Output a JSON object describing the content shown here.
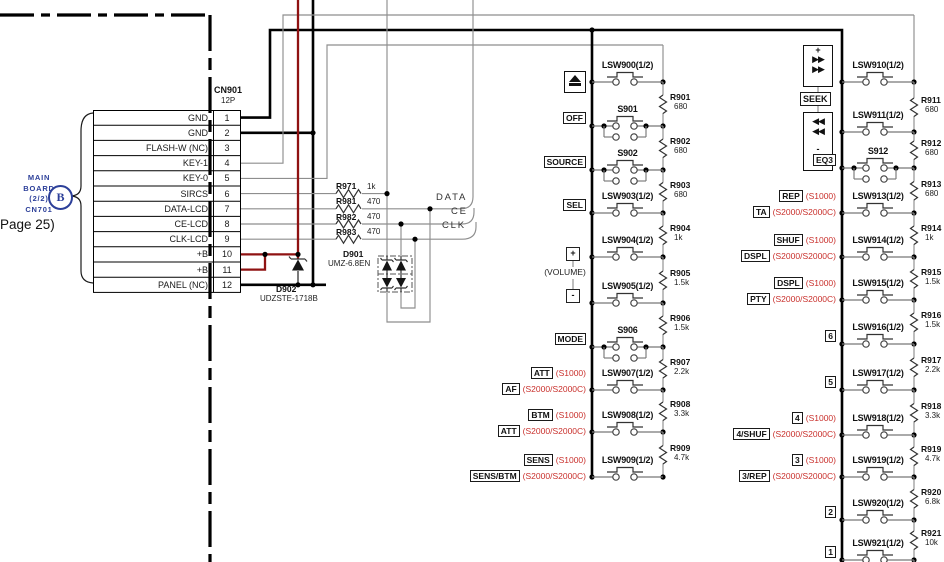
{
  "connector": {
    "name": "CN901",
    "type_label": "12P",
    "pins": [
      {
        "no": "1",
        "name": "GND"
      },
      {
        "no": "2",
        "name": "GND"
      },
      {
        "no": "3",
        "name": "FLASH-W (NC)"
      },
      {
        "no": "4",
        "name": "KEY-1"
      },
      {
        "no": "5",
        "name": "KEY-0"
      },
      {
        "no": "6",
        "name": "SIRCS"
      },
      {
        "no": "7",
        "name": "DATA-LCD"
      },
      {
        "no": "8",
        "name": "CE-LCD"
      },
      {
        "no": "9",
        "name": "CLK-LCD"
      },
      {
        "no": "10",
        "name": "+B"
      },
      {
        "no": "11",
        "name": "+B"
      },
      {
        "no": "12",
        "name": "PANEL (NC)"
      }
    ]
  },
  "left_note": {
    "lines": [
      "MAIN",
      "BOARD",
      "(2/2)",
      "CN701"
    ],
    "circle_letter": "B",
    "page_ref": "Page 25)"
  },
  "inline_resistors": [
    {
      "name": "R971",
      "value": "1k"
    },
    {
      "name": "R981",
      "value": "470"
    },
    {
      "name": "R982",
      "value": "470"
    },
    {
      "name": "R983",
      "value": "470"
    }
  ],
  "signals": {
    "data": "DATA",
    "ce": "CE",
    "clk": "CLK"
  },
  "diodes": {
    "d901": {
      "name": "D901",
      "part": "UMZ-6.8EN"
    },
    "d902": {
      "name": "D902",
      "part": "UDZSTE-1718B"
    }
  },
  "volume_group": {
    "plus": "+",
    "label": "(VOLUME)",
    "minus": "-"
  },
  "seek_group": {
    "plus": "+",
    "forward": "▶▶",
    "rewind": "◀◀",
    "label": "SEEK",
    "minus": "-"
  },
  "middle_column": {
    "rows": [
      {
        "switch": "LSW900(1/2)",
        "type": "lsw",
        "resistor": {
          "name": "R901",
          "value": "680"
        }
      },
      {
        "switch": "S901",
        "type": "s4",
        "labels": [
          {
            "box": "OFF"
          }
        ],
        "resistor": {
          "name": "R902",
          "value": "680"
        }
      },
      {
        "switch": "S902",
        "type": "s4",
        "labels": [
          {
            "box": "SOURCE"
          }
        ],
        "resistor": {
          "name": "R903",
          "value": "680"
        }
      },
      {
        "switch": "LSW903(1/2)",
        "type": "lsw",
        "labels": [
          {
            "box": "SEL"
          }
        ],
        "resistor": {
          "name": "R904",
          "value": "1k"
        }
      },
      {
        "switch": "LSW904(1/2)",
        "type": "lsw",
        "resistor": {
          "name": "R905",
          "value": "1.5k"
        }
      },
      {
        "switch": "LSW905(1/2)",
        "type": "lsw",
        "resistor": {
          "name": "R906",
          "value": "1.5k"
        }
      },
      {
        "switch": "S906",
        "type": "s4",
        "labels": [
          {
            "box": "MODE"
          }
        ],
        "resistor": {
          "name": "R907",
          "value": "2.2k"
        }
      },
      {
        "switch": "LSW907(1/2)",
        "type": "lsw",
        "labels": [
          {
            "box": "ATT",
            "variant": "(S1000)"
          },
          {
            "box": "AF",
            "variant": "(S2000/S2000C)"
          }
        ],
        "resistor": {
          "name": "R908",
          "value": "3.3k"
        }
      },
      {
        "switch": "LSW908(1/2)",
        "type": "lsw",
        "labels": [
          {
            "box": "BTM",
            "variant": "(S1000)"
          },
          {
            "box": "ATT",
            "variant": "(S2000/S2000C)"
          }
        ],
        "resistor": {
          "name": "R909",
          "value": "4.7k"
        }
      },
      {
        "switch": "LSW909(1/2)",
        "type": "lsw",
        "labels": [
          {
            "box": "SENS",
            "variant": "(S1000)"
          },
          {
            "box": "SENS/BTM",
            "variant": "(S2000/S2000C)"
          }
        ]
      }
    ]
  },
  "right_column": {
    "rows": [
      {
        "switch": "LSW910(1/2)",
        "type": "lsw",
        "resistor": {
          "name": "R911",
          "value": "680"
        }
      },
      {
        "switch": "LSW911(1/2)",
        "type": "lsw",
        "resistor": {
          "name": "R912",
          "value": "680"
        }
      },
      {
        "switch": "S912",
        "type": "s4",
        "labels": [
          {
            "box": "EQ3"
          }
        ],
        "resistor": {
          "name": "R913",
          "value": "680"
        }
      },
      {
        "switch": "LSW913(1/2)",
        "type": "lsw",
        "labels": [
          {
            "box": "REP",
            "variant": "(S1000)"
          },
          {
            "box": "TA",
            "variant": "(S2000/S2000C)"
          }
        ],
        "resistor": {
          "name": "R914",
          "value": "1k"
        }
      },
      {
        "switch": "LSW914(1/2)",
        "type": "lsw",
        "labels": [
          {
            "box": "SHUF",
            "variant": "(S1000)"
          },
          {
            "box": "DSPL",
            "variant": "(S2000/S2000C)"
          }
        ],
        "resistor": {
          "name": "R915",
          "value": "1.5k"
        }
      },
      {
        "switch": "LSW915(1/2)",
        "type": "lsw",
        "labels": [
          {
            "box": "DSPL",
            "variant": "(S1000)"
          },
          {
            "box": "PTY",
            "variant": "(S2000/S2000C)"
          }
        ],
        "resistor": {
          "name": "R916",
          "value": "1.5k"
        }
      },
      {
        "switch": "LSW916(1/2)",
        "type": "lsw",
        "labels": [
          {
            "box": "6"
          }
        ],
        "resistor": {
          "name": "R917",
          "value": "2.2k"
        }
      },
      {
        "switch": "LSW917(1/2)",
        "type": "lsw",
        "labels": [
          {
            "box": "5"
          }
        ],
        "resistor": {
          "name": "R918",
          "value": "3.3k"
        }
      },
      {
        "switch": "LSW918(1/2)",
        "type": "lsw",
        "labels": [
          {
            "box": "4",
            "variant": "(S1000)"
          },
          {
            "box": "4/SHUF",
            "variant": "(S2000/S2000C)"
          }
        ],
        "resistor": {
          "name": "R919",
          "value": "4.7k"
        }
      },
      {
        "switch": "LSW919(1/2)",
        "type": "lsw",
        "labels": [
          {
            "box": "3",
            "variant": "(S1000)"
          },
          {
            "box": "3/REP",
            "variant": "(S2000/S2000C)"
          }
        ],
        "resistor": {
          "name": "R920",
          "value": "6.8k"
        }
      },
      {
        "switch": "LSW920(1/2)",
        "type": "lsw",
        "labels": [
          {
            "box": "2"
          }
        ],
        "resistor": {
          "name": "R921",
          "value": "10k"
        }
      },
      {
        "switch": "LSW921(1/2)",
        "type": "lsw",
        "labels": [
          {
            "box": "1"
          }
        ]
      }
    ]
  },
  "colors": {
    "wire_red": "#8f1212",
    "text_red": "#c9302c",
    "text_blue": "#2c3f99"
  }
}
